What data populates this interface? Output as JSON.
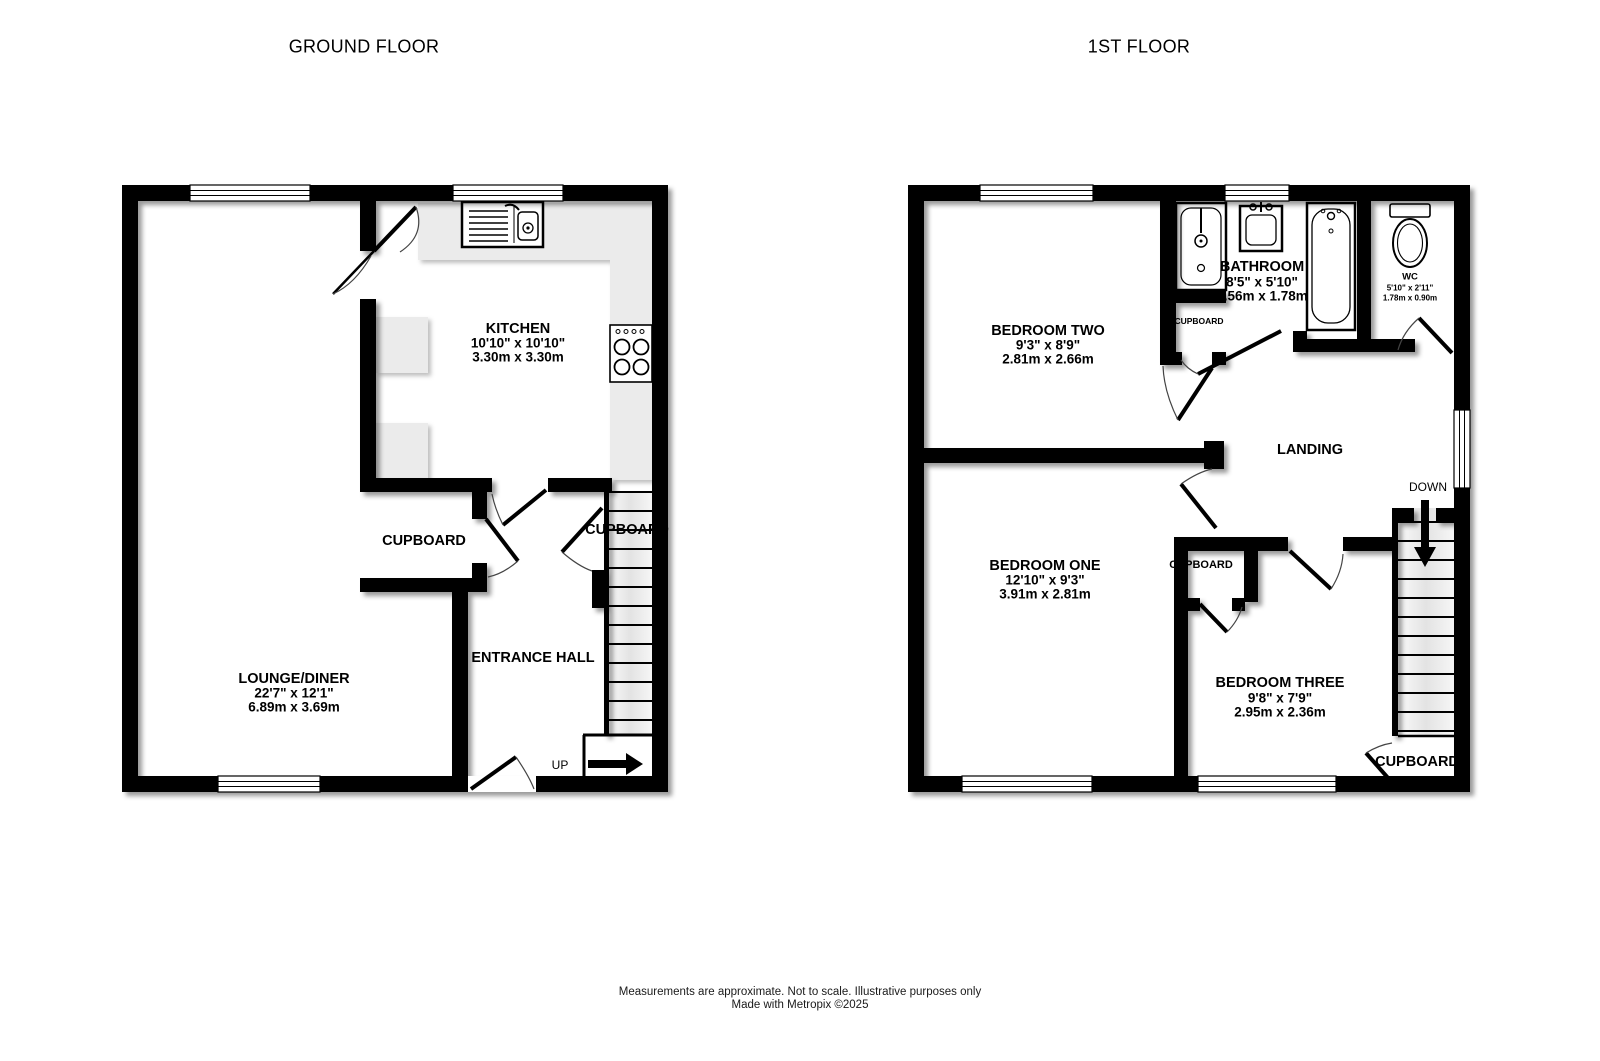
{
  "titles": {
    "ground": "GROUND FLOOR",
    "first": "1ST FLOOR"
  },
  "ground_floor": {
    "kitchen": {
      "name": "KITCHEN",
      "imperial": "10'10\"  x 10'10\"",
      "metric": "3.30m  x 3.30m"
    },
    "lounge_diner": {
      "name": "LOUNGE/DINER",
      "imperial": "22'7\"  x 12'1\"",
      "metric": "6.89m  x 3.69m"
    },
    "entrance_hall": {
      "name": "ENTRANCE HALL"
    },
    "cupboard_left": {
      "name": "CUPBOARD"
    },
    "cupboard_understairs": {
      "name": "CUPBOARD"
    },
    "stairs": {
      "direction_label": "UP"
    }
  },
  "first_floor": {
    "bedroom_two": {
      "name": "BEDROOM TWO",
      "imperial": "9'3\"  x 8'9\"",
      "metric": "2.81m  x 2.66m"
    },
    "bathroom": {
      "name": "BATHROOM",
      "imperial": "8'5\"  x 5'10\"",
      "metric": "2.56m  x 1.78m"
    },
    "wc": {
      "name": "WC",
      "imperial": "5'10\"  x 2'11\"",
      "metric": "1.78m  x 0.90m"
    },
    "cupboard_bathroom": {
      "name": "CUPBOARD"
    },
    "landing": {
      "name": "LANDING"
    },
    "stairs": {
      "direction_label": "DOWN"
    },
    "bedroom_one": {
      "name": "BEDROOM ONE",
      "imperial": "12'10\"  x 9'3\"",
      "metric": "3.91m  x 2.81m"
    },
    "cupboard_middle": {
      "name": "CUPBOARD"
    },
    "bedroom_three": {
      "name": "BEDROOM THREE",
      "imperial": "9'8\"  x 7'9\"",
      "metric": "2.95m  x 2.36m"
    },
    "cupboard_understairs": {
      "name": "CUPBOARD"
    }
  },
  "footer": {
    "disclaimer": "Measurements are approximate.  Not to scale.  Illustrative purposes only",
    "credit": "Made with Metropix ©2025"
  },
  "colors": {
    "wall": "#000000",
    "counter": "#ebebeb",
    "stairs": "#f0f0f0",
    "background": "#ffffff"
  }
}
